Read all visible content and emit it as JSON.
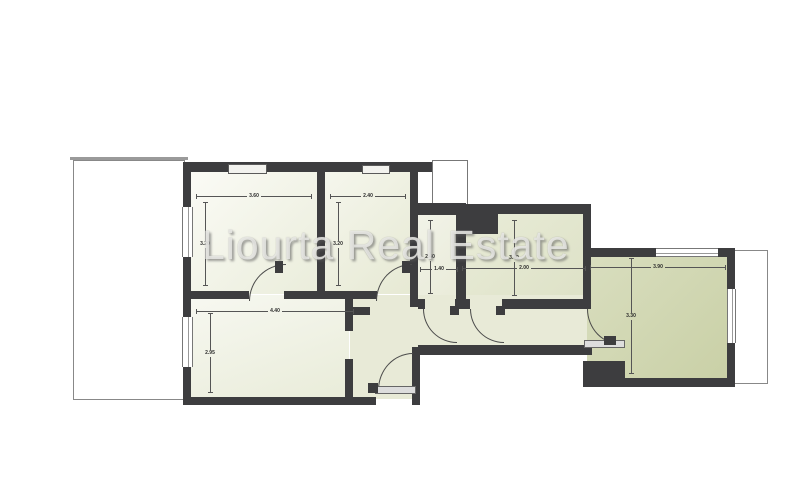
{
  "watermark": "Liourta Real Estate",
  "rooms": {
    "bedroom_1": {
      "width": "3.60",
      "height": "3.20"
    },
    "bedroom_2": {
      "width": "2.40",
      "height": "3.20"
    },
    "bathroom": {
      "width": "1.40",
      "height": "2.40"
    },
    "kitchen": {
      "width": "2.00",
      "height": "3.40"
    },
    "bedroom_3": {
      "width": "4.40",
      "height": "2.95"
    },
    "living_room": {
      "width": "3.90",
      "height": "3.30"
    }
  }
}
